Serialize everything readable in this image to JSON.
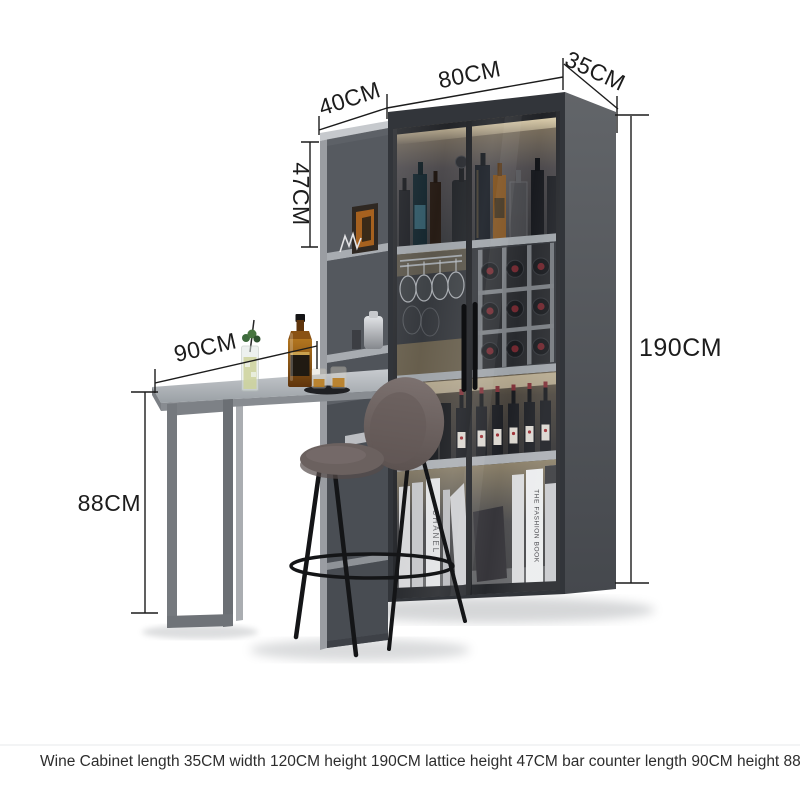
{
  "dimensions": {
    "shelf_width": "40CM",
    "cabinet_width": "80CM",
    "cabinet_depth": "35CM",
    "cabinet_height": "190CM",
    "lattice_height": "47CM",
    "counter_length": "90CM",
    "counter_height": "88CM"
  },
  "caption": "Wine Cabinet length 35CM width 120CM height 190CM lattice height 47CM bar counter length 90CM height 88CN",
  "decor": {
    "left_book": "CHANEL",
    "right_book": "THE FASHION BOOK"
  },
  "colors": {
    "background": "#ffffff",
    "cabinet_body": "#32353a",
    "cabinet_side": "#54575c",
    "shelf_unit": "#5d6167",
    "shelf_edge": "#a8acb1",
    "counter_top": "#aeb2b7",
    "counter_leg": "#75797e",
    "stool_seat": "#6e6462",
    "stool_leg": "#141517",
    "wine_cap_red": "#70262e",
    "led_warm": "#f5e7c2",
    "dimension_line": "#1c1c1c"
  }
}
